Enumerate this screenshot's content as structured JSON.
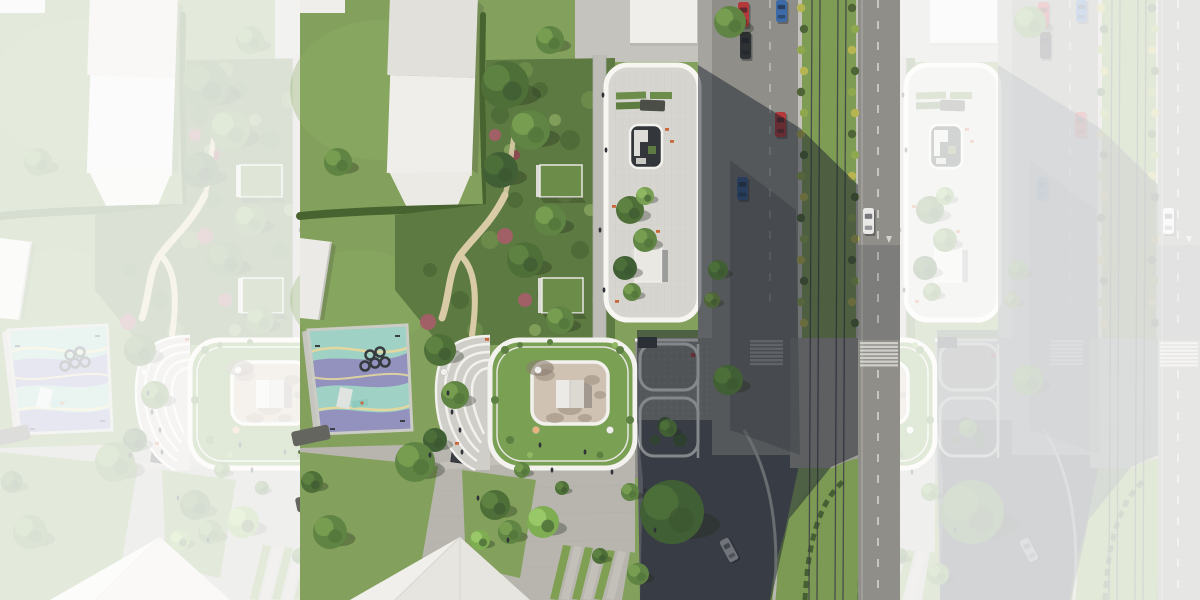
{
  "meta": {
    "description": "Aerial top-down architectural rendering of a residential complex: two white buildings with rooftop gardens and a circular courtyard, communal gardens, a playground, a plaza with trees, and a tram boulevard with parked cars; the center square is sharp and both sides are faded continuations of the same render.",
    "type": "aerial-render"
  },
  "palette": {
    "lawn": "#83a15c",
    "lawnLight": "#8fae66",
    "garden": "#5d7a42",
    "hedge": "#47632f",
    "sand": "#d8cba6",
    "roofWhite": "#efeeea",
    "roofShade": "#e2e0db",
    "terrace": "#d6d5d0",
    "parapet": "#f7f6f2",
    "courtyardDark": "#33363a",
    "innerCourt": "#cfc2b2",
    "houseWhite": "#eceae6",
    "asphalt": "#8f8e89",
    "cobble": "#a5a49e",
    "cobbleDark": "#8f8e88",
    "median": "#7f9c55",
    "rail": "#3c4045",
    "curb": "#c3c1ba",
    "bushYellow": "#b7b551",
    "bushDark": "#4e6436",
    "bushLight": "#8fa84e",
    "paver": "#b7b5ae",
    "paverLight": "#c5c3bc",
    "stripe": "#d5d4cf",
    "playTeal": "#9fd2c5",
    "playPurple": "#9391bd",
    "playYellow": "#e3d79f",
    "greenRoof": "#79a053",
    "carRed": "#b5383b",
    "carBlue": "#3d6ba8",
    "carDark": "#2e3134",
    "carWhite": "#e9e9e7",
    "carSilver": "#c7c9cb",
    "personDark": "#303338",
    "furnitureOrange": "#c8693c",
    "shadow": "rgba(28,33,43,0.50)",
    "fadeWhite": "#ffffff",
    "fadeOpacity": "0.78"
  },
  "scene": {
    "treeTones": {
      "dark": "#4e7038",
      "mid": "#5f8443",
      "light": "#79a052",
      "bright": "#7fae52",
      "shade": "#415f35",
      "bush": "#4e6436"
    },
    "trees": [
      {
        "x": 38,
        "y": 162,
        "r": 14,
        "tone": "mid"
      },
      {
        "x": 205,
        "y": 85,
        "r": 24,
        "tone": "dark"
      },
      {
        "x": 230,
        "y": 130,
        "r": 20,
        "tone": "mid"
      },
      {
        "x": 200,
        "y": 170,
        "r": 18,
        "tone": "shade"
      },
      {
        "x": 250,
        "y": 40,
        "r": 14,
        "tone": "mid"
      },
      {
        "x": 250,
        "y": 220,
        "r": 16,
        "tone": "mid"
      },
      {
        "x": 225,
        "y": 260,
        "r": 18,
        "tone": "dark"
      },
      {
        "x": 260,
        "y": 320,
        "r": 14,
        "tone": "mid"
      },
      {
        "x": 140,
        "y": 350,
        "r": 16,
        "tone": "dark"
      },
      {
        "x": 155,
        "y": 395,
        "r": 14,
        "tone": "mid"
      },
      {
        "x": 135,
        "y": 440,
        "r": 12,
        "tone": "shade"
      },
      {
        "x": 30,
        "y": 532,
        "r": 17,
        "tone": "mid"
      },
      {
        "x": 12,
        "y": 482,
        "r": 11,
        "tone": "dark"
      },
      {
        "x": 115,
        "y": 462,
        "r": 20,
        "tone": "mid"
      },
      {
        "x": 243,
        "y": 522,
        "r": 16,
        "tone": "bright"
      },
      {
        "x": 222,
        "y": 470,
        "r": 8,
        "tone": "mid"
      },
      {
        "x": 262,
        "y": 488,
        "r": 7,
        "tone": "dark"
      },
      {
        "x": 330,
        "y": 492,
        "r": 9,
        "tone": "mid"
      },
      {
        "x": 195,
        "y": 505,
        "r": 15,
        "tone": "dark"
      },
      {
        "x": 210,
        "y": 532,
        "r": 12,
        "tone": "mid"
      },
      {
        "x": 180,
        "y": 540,
        "r": 10,
        "tone": "bright"
      },
      {
        "x": 372,
        "y": 512,
        "r": 32,
        "tone": "shade"
      },
      {
        "x": 430,
        "y": 22,
        "r": 16,
        "tone": "mid"
      },
      {
        "x": 418,
        "y": 270,
        "r": 10,
        "tone": "shade"
      },
      {
        "x": 412,
        "y": 300,
        "r": 8,
        "tone": "bush"
      },
      {
        "x": 428,
        "y": 380,
        "r": 15,
        "tone": "shade"
      },
      {
        "x": 368,
        "y": 428,
        "r": 9,
        "tone": "shade"
      },
      {
        "x": 338,
        "y": 574,
        "r": 11,
        "tone": "mid"
      },
      {
        "x": 300,
        "y": 556,
        "r": 8,
        "tone": "dark"
      },
      {
        "x": 330,
        "y": 210,
        "r": 14,
        "tone": "dark"
      },
      {
        "x": 345,
        "y": 240,
        "r": 12,
        "tone": "mid"
      },
      {
        "x": 325,
        "y": 268,
        "r": 12,
        "tone": "shade"
      },
      {
        "x": 345,
        "y": 196,
        "r": 9,
        "tone": "light"
      },
      {
        "x": 332,
        "y": 292,
        "r": 9,
        "tone": "mid"
      }
    ],
    "people": [
      {
        "x": 303,
        "y": 95
      },
      {
        "x": 306,
        "y": 150
      },
      {
        "x": 300,
        "y": 230
      },
      {
        "x": 304,
        "y": 290
      },
      {
        "x": 130,
        "y": 455
      },
      {
        "x": 162,
        "y": 452
      },
      {
        "x": 178,
        "y": 498
      },
      {
        "x": 208,
        "y": 540
      },
      {
        "x": 252,
        "y": 470
      },
      {
        "x": 312,
        "y": 472
      },
      {
        "x": 345,
        "y": 490
      },
      {
        "x": 355,
        "y": 530
      },
      {
        "x": 240,
        "y": 445
      },
      {
        "x": 285,
        "y": 452
      },
      {
        "x": 148,
        "y": 393
      },
      {
        "x": 152,
        "y": 412
      },
      {
        "x": 160,
        "y": 430
      }
    ],
    "furniture": [
      {
        "x": 365,
        "y": 128
      },
      {
        "x": 370,
        "y": 140
      },
      {
        "x": 312,
        "y": 205
      },
      {
        "x": 356,
        "y": 230
      },
      {
        "x": 315,
        "y": 300
      },
      {
        "x": 185,
        "y": 338
      },
      {
        "x": 155,
        "y": 442
      }
    ],
    "umbrellas": [
      {
        "x": 144,
        "y": 372,
        "c": "#f0efec"
      },
      {
        "x": 238,
        "y": 370,
        "c": "#f0efec"
      },
      {
        "x": 310,
        "y": 430,
        "c": "#f0efec"
      },
      {
        "x": 236,
        "y": 430,
        "c": "#e8b27a"
      }
    ],
    "cars": [
      {
        "x": 438,
        "y": 2,
        "w": 11,
        "h": 25,
        "color": "carRed",
        "rot": 0
      },
      {
        "x": 440,
        "y": 32,
        "w": 11,
        "h": 27,
        "color": "carDark",
        "rot": 0
      },
      {
        "x": 476,
        "y": 0,
        "w": 11,
        "h": 22,
        "color": "carBlue",
        "rot": 0
      },
      {
        "x": 475,
        "y": 112,
        "w": 11,
        "h": 25,
        "color": "carRed",
        "rot": 0
      },
      {
        "x": 437,
        "y": 177,
        "w": 11,
        "h": 23,
        "color": "carBlue",
        "rot": 0
      },
      {
        "x": 563,
        "y": 208,
        "w": 11,
        "h": 26,
        "color": "carWhite",
        "rot": 0
      },
      {
        "x": 424,
        "y": 538,
        "w": 10,
        "h": 24,
        "color": "carSilver",
        "rot": -28
      }
    ],
    "tram": {
      "railXs": [
        512,
        520,
        538,
        546
      ],
      "leanDx": -3,
      "y0": 0,
      "y1": 600
    },
    "medianBushes": {
      "rowXs": [
        502.5,
        553.5
      ],
      "yStart": 8,
      "yEnd": 332,
      "step": 21,
      "colors": [
        "#b7b551",
        "#4e6436",
        "#8fa84e"
      ]
    },
    "crosswalks": [
      {
        "x": 560,
        "y": 342,
        "w": 38,
        "count": 7,
        "gap": 3.7,
        "h": 2.3
      },
      {
        "x": 450,
        "y": 340,
        "w": 33,
        "count": 7,
        "gap": 3.8,
        "h": 2.4
      }
    ]
  }
}
